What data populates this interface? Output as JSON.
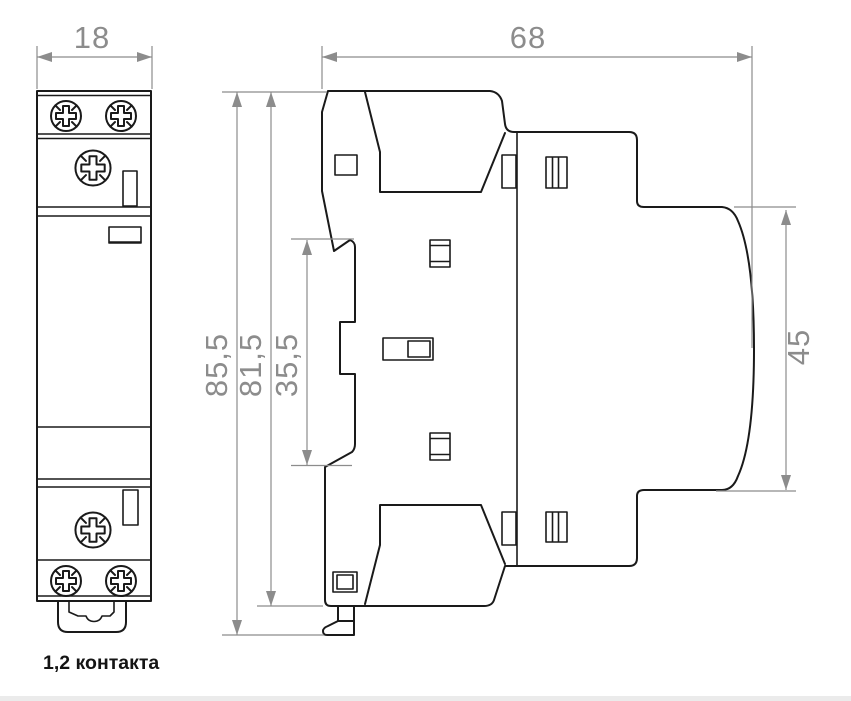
{
  "drawing": {
    "caption": "1,2 контакта",
    "type_note": "technical dimension drawing of a modular DIN-rail contactor, front view and side view"
  },
  "dimensions": {
    "front_width": "18",
    "side_width": "68",
    "height_total": "85,5",
    "height_body": "81,5",
    "height_mid_section": "35,5",
    "height_back_section": "45"
  },
  "colors": {
    "line": "#1a1a1a",
    "dimension": "#8c8c8c",
    "background": "#ffffff",
    "footer_strip": "#ebebeb",
    "caption": "#141414"
  }
}
